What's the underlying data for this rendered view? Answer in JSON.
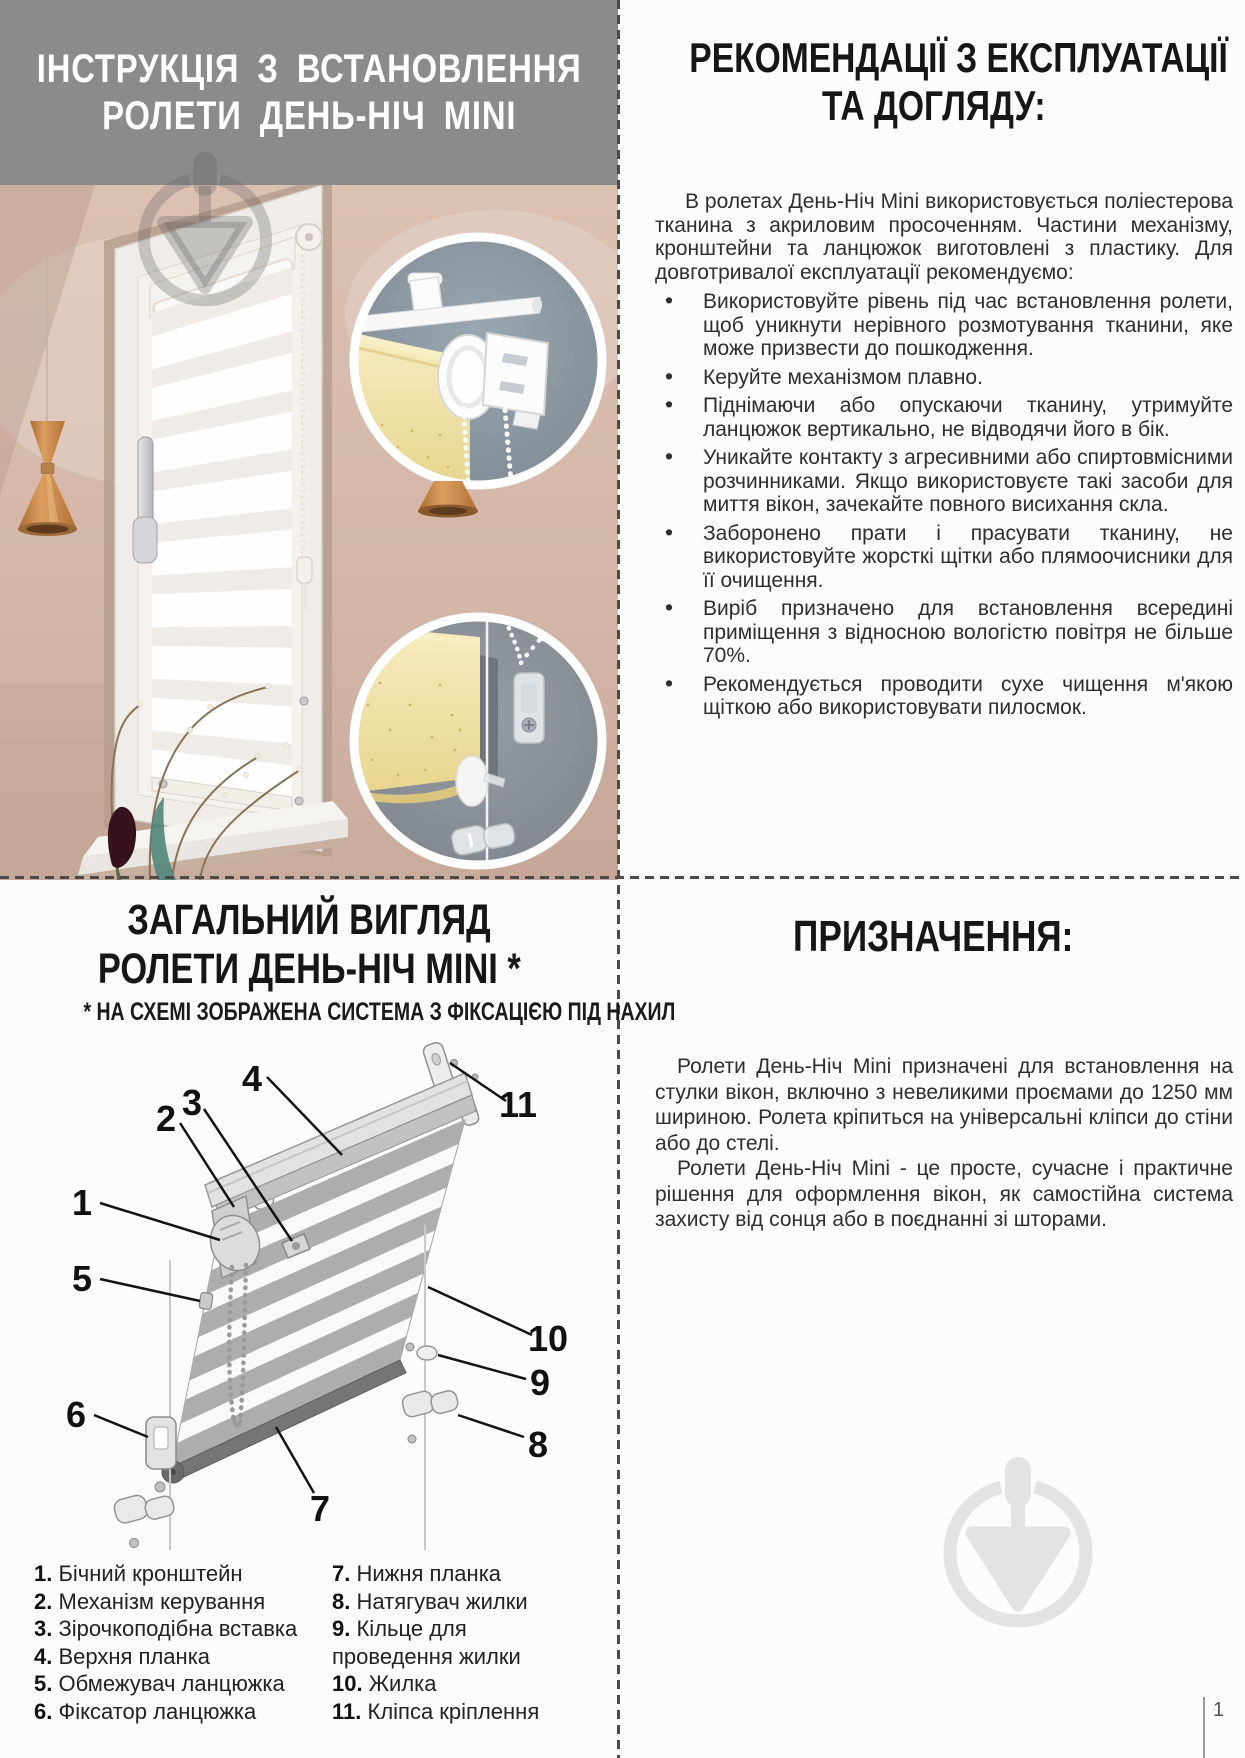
{
  "page": {
    "number": "1"
  },
  "colors": {
    "banner_gray": "#8b8b8b",
    "heading_black": "#161616",
    "dash_line": "#4a4a4a",
    "watermark_gray": "#e3e3e3",
    "inset_blue_gray": "#8b98a2",
    "fabric_yellow": "#eedd9c",
    "copper_lamp": "#c08048"
  },
  "icons": {
    "brand_watermark": "plumb-triangle-in-circle-icon"
  },
  "left": {
    "banner_title_line1": "ІНСТРУКЦІЯ З ВСТАНОВЛЕННЯ",
    "banner_title_line2": "РОЛЕТИ ДЕНЬ-НІЧ MINI",
    "overview_title_line1": "ЗАГАЛЬНИЙ ВИГЛЯД",
    "overview_title_line2": "РОЛЕТИ ДЕНЬ-НІЧ MINI *",
    "overview_note": "* НА СХЕМІ ЗОБРАЖЕНА СИСТЕМА З ФІКСАЦІЄЮ ПІД НАХИЛ",
    "diagram_numbers": [
      "1",
      "2",
      "3",
      "4",
      "5",
      "6",
      "7",
      "8",
      "9",
      "10",
      "11"
    ],
    "legend_col1": [
      {
        "num": "1.",
        "text": "Бічний кронштейн"
      },
      {
        "num": "2.",
        "text": "Механізм керування"
      },
      {
        "num": "3.",
        "text": "Зірочкоподібна вставка"
      },
      {
        "num": "4.",
        "text": "Верхня планка"
      },
      {
        "num": "5.",
        "text": "Обмежувач ланцюжка"
      },
      {
        "num": "6.",
        "text": "Фіксатор ланцюжка"
      }
    ],
    "legend_col2": [
      {
        "num": "7.",
        "text": "Нижня планка"
      },
      {
        "num": "8.",
        "text": "Натягувач жилки"
      },
      {
        "num": "9.",
        "text": "Кільце для\nпроведення жилки"
      },
      {
        "num": "10.",
        "text": "Жилка"
      },
      {
        "num": "11.",
        "text": "Кліпса кріплення"
      }
    ]
  },
  "right": {
    "recommendations_title_line1": "РЕКОМЕНДАЦІЇ З ЕКСПЛУАТАЦІЇ",
    "recommendations_title_line2": "ТА ДОГЛЯДУ:",
    "intro": "В ролетах День-Ніч Mini використовується поліестерова тканина з акриловим просоченням. Частини механізму, кронштейни та ланцюжок виготовлені з пластику. Для довготривалої експлуатації рекомендуємо:",
    "bullets": [
      "Використовуйте рівень під час встановлення ролети, щоб уникнути нерівного розмотування тканини, яке може призвести до пошкодження.",
      "Керуйте механізмом плавно.",
      "Піднімаючи або опускаючи тканину, утримуйте ланцюжок вертикально, не відводячи його в бік.",
      "Уникайте контакту з агресивними або спиртовмісними розчинниками. Якщо використовуєте такі засоби для миття вікон, зачекайте повного висихання скла.",
      "Заборонено прати і прасувати тканину, не використовуйте жорсткі щітки або плямоочисники для її очищення.",
      "Виріб призначено для встановлення всередині приміщення з відносною вологістю повітря не більше 70%.",
      "Рекомендується проводити сухе чищення м'якою щіткою або використовувати пилосмок."
    ],
    "purpose_title": "ПРИЗНАЧЕННЯ:",
    "purpose_p1": "Ролети День-Ніч Mini призначені для встановлення на стулки вікон, включно з невеликими проємами до 1250 мм шириною. Ролета кріпиться на універсальні кліпси до стіни або до стелі.",
    "purpose_p2": "Ролети День-Ніч Mini - це просте, сучасне і практичне рішення для оформлення вікон, як самостійна система захисту від сонця або в поєднанні зі шторами."
  }
}
